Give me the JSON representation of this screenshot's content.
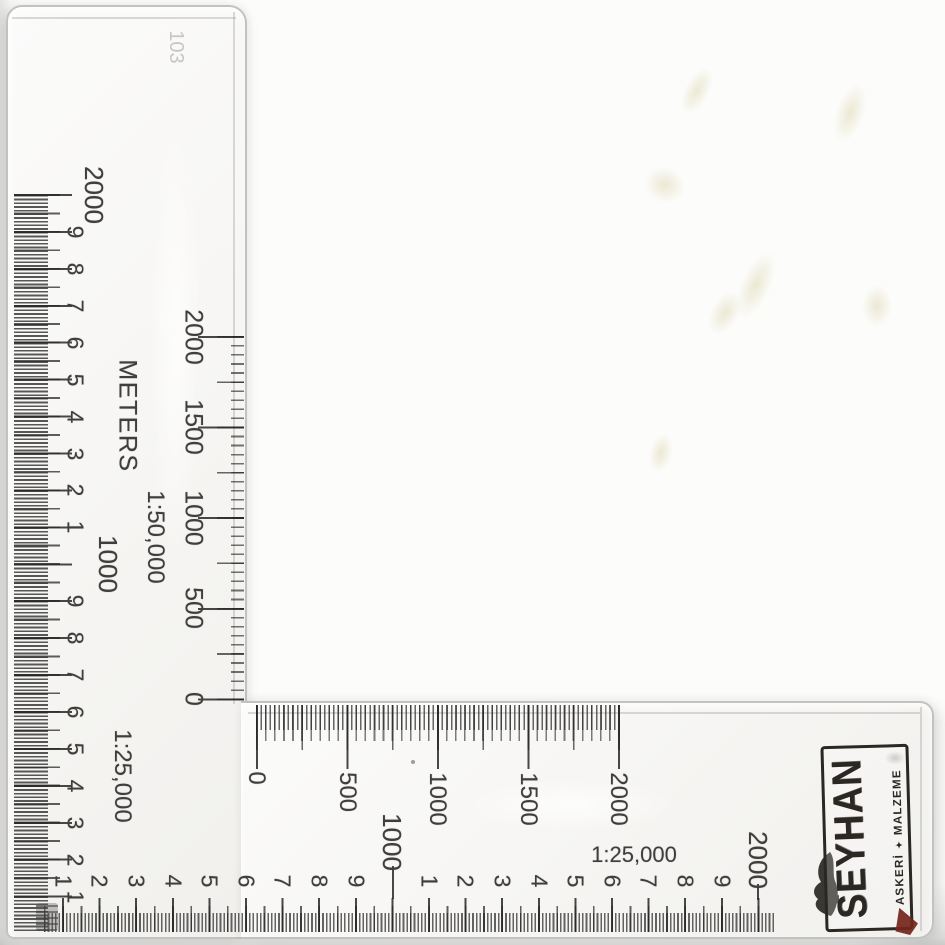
{
  "colors": {
    "background": "#fcfcfb",
    "ruler_surface": "#f7f6f4",
    "edge": "#c2c2c1",
    "ink": "#3f3e3c",
    "faint_ink": "#c8c6c2",
    "logo_ink": "#2b2823",
    "logo_red": "#74251a",
    "smudge_yellow": "#ded8b2"
  },
  "ruler": {
    "faint_marking": "103",
    "left_scale": {
      "ratio_label": "1:25,000",
      "labels": [
        "2000",
        "9",
        "8",
        "7",
        "6",
        "5",
        "4",
        "3",
        "2",
        "1",
        "1000",
        "9",
        "8",
        "7",
        "6",
        "5",
        "4",
        "3",
        "2",
        "1"
      ]
    },
    "meters_scale": {
      "unit_label": "METERS",
      "ratio_label": "1:50,000",
      "vertical_labels": [
        "0",
        "500",
        "1000",
        "1500",
        "2000"
      ],
      "horizontal_labels": [
        "0",
        "500",
        "1000",
        "1500",
        "2000"
      ]
    },
    "bottom_scale": {
      "ratio_label": "1:25,000",
      "labels": [
        "1",
        "2",
        "3",
        "4",
        "5",
        "6",
        "7",
        "8",
        "9",
        "1000",
        "1",
        "2",
        "3",
        "4",
        "5",
        "6",
        "7",
        "8",
        "9",
        "2000"
      ]
    },
    "logo": {
      "brand": "SEYHAN",
      "subtitle_left": "ASKERİ",
      "subtitle_right": "MALZEME",
      "star_glyph": "✦"
    }
  }
}
